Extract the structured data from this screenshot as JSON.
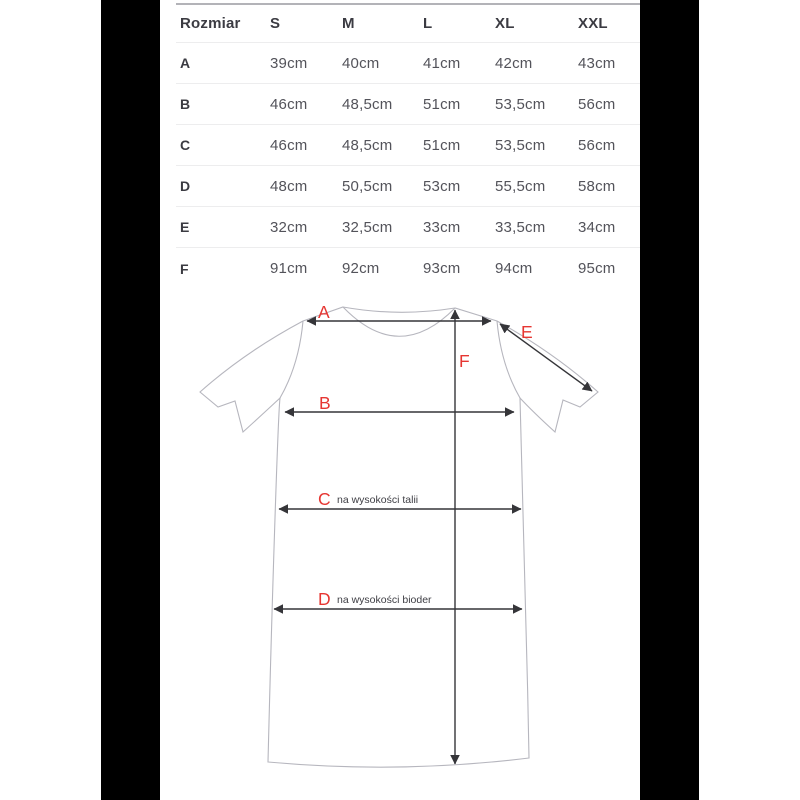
{
  "table": {
    "header": [
      "Rozmiar",
      "S",
      "M",
      "L",
      "XL",
      "XXL"
    ],
    "rows": [
      {
        "label": "A",
        "values": [
          "39cm",
          "40cm",
          "41cm",
          "42cm",
          "43cm"
        ]
      },
      {
        "label": "B",
        "values": [
          "46cm",
          "48,5cm",
          "51cm",
          "53,5cm",
          "56cm"
        ]
      },
      {
        "label": "C",
        "values": [
          "46cm",
          "48,5cm",
          "51cm",
          "53,5cm",
          "56cm"
        ]
      },
      {
        "label": "D",
        "values": [
          "48cm",
          "50,5cm",
          "53cm",
          "55,5cm",
          "58cm"
        ]
      },
      {
        "label": "E",
        "values": [
          "32cm",
          "32,5cm",
          "33cm",
          "33,5cm",
          "34cm"
        ]
      },
      {
        "label": "F",
        "values": [
          "91cm",
          "92cm",
          "93cm",
          "94cm",
          "95cm"
        ]
      }
    ]
  },
  "diagram": {
    "labels": {
      "a": "A",
      "b": "B",
      "c": "C",
      "d": "D",
      "e": "E",
      "f": "F"
    },
    "annotations": {
      "c_note": "na wysokości talii",
      "d_note": "na wysokości bioder"
    },
    "colors": {
      "label_red": "#e63632",
      "garment_outline": "#b6b6be",
      "arrow": "#353539",
      "letterbox": "#000000"
    }
  }
}
